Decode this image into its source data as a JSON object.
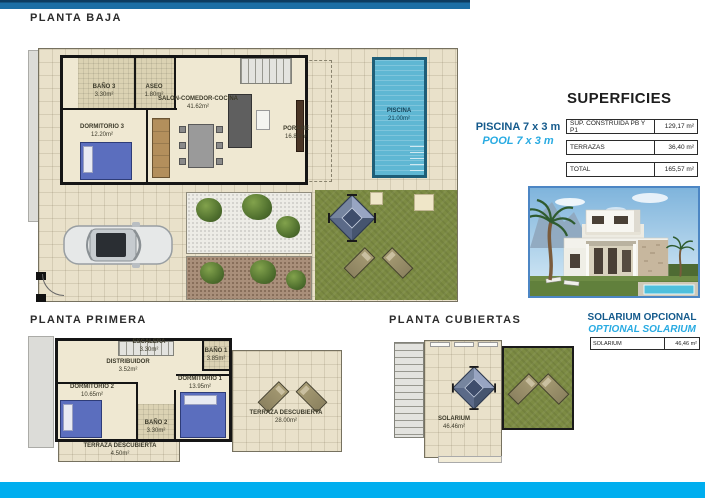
{
  "page": {
    "accent_dark_blue": "#1C6EA4",
    "accent_cyan": "#00AEEF",
    "text_blue": "#145A8C"
  },
  "plans": {
    "baja": {
      "title": "PLANTA BAJA",
      "rooms": {
        "bano3": {
          "name": "BAÑO 3",
          "area": "3.30m²"
        },
        "aseo": {
          "name": "ASEO",
          "area": "1.80m²"
        },
        "salon": {
          "name": "SALON-COMEDOR-COCINA",
          "area": "41.62m²"
        },
        "dormitorio3": {
          "name": "DORMITORIO 3",
          "area": "12.20m²"
        },
        "porche": {
          "name": "PORCHE",
          "area": "16.80m²"
        },
        "piscina": {
          "name": "PISCINA",
          "area": "21.00m²"
        }
      }
    },
    "primera": {
      "title": "PLANTA PRIMERA",
      "rooms": {
        "escalera": {
          "name": "ESCALERA",
          "area": "3.30m²"
        },
        "distribuidor": {
          "name": "DISTRIBUIDOR",
          "area": "3.52m²"
        },
        "bano1": {
          "name": "BAÑO 1",
          "area": "3.85m²"
        },
        "dormitorio1": {
          "name": "DORMITORIO 1",
          "area": "13.95m²"
        },
        "dormitorio2": {
          "name": "DORMITORIO 2",
          "area": "10.65m²"
        },
        "bano2": {
          "name": "BAÑO 2",
          "area": "3.30m²"
        },
        "terraza_izq": {
          "name": "TERRAZA DESCUBIERTA",
          "area": "4.50m²"
        },
        "terraza_der": {
          "name": "TERRAZA DESCUBIERTA",
          "area": "28.00m²"
        }
      }
    },
    "cubiertas": {
      "title": "PLANTA CUBIERTAS",
      "rooms": {
        "solarium": {
          "name": "SOLARIUM",
          "area": "46.46m²"
        }
      }
    }
  },
  "pool_note": {
    "es": "PISCINA 7 x 3 m",
    "en": "POOL 7 x 3 m"
  },
  "superficies": {
    "title": "SUPERFICIES",
    "rows": [
      {
        "label": "SUP. CONSTRUIDA PB Y P1",
        "value": "129,17 m²"
      },
      {
        "label": "TERRAZAS",
        "value": "36,40 m²"
      },
      {
        "label": "TOTAL",
        "value": "165,57 m²"
      }
    ]
  },
  "solarium_note": {
    "es": "SOLARIUM OPCIONAL",
    "en": "OPTIONAL SOLARIUM",
    "row": {
      "label": "SOLARIUM",
      "value": "46,46 m²"
    }
  }
}
